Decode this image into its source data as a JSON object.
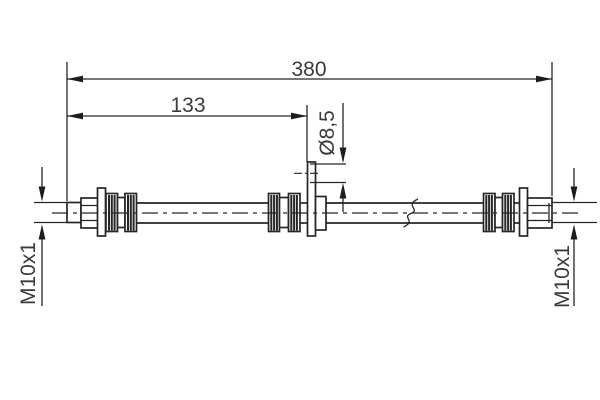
{
  "drawing": {
    "kind": "technical-drawing",
    "subject": "brake-hose-with-mounting-bracket",
    "background_color": "#ffffff",
    "line_color": "#262626",
    "text_color": "#3a3a3a",
    "dimensions": [
      {
        "id": "overall-length",
        "label": "380",
        "value": 380,
        "orientation": "horizontal"
      },
      {
        "id": "bracket-offset-length",
        "label": "133",
        "value": 133,
        "orientation": "horizontal"
      },
      {
        "id": "bracket-hole-diameter",
        "label": "Ø8,5",
        "value": 8.5,
        "orientation": "vertical-rotated"
      },
      {
        "id": "left-thread-size",
        "label": "M10x1",
        "orientation": "vertical-rotated"
      },
      {
        "id": "right-thread-size",
        "label": "M10x1",
        "orientation": "vertical-rotated"
      }
    ]
  }
}
